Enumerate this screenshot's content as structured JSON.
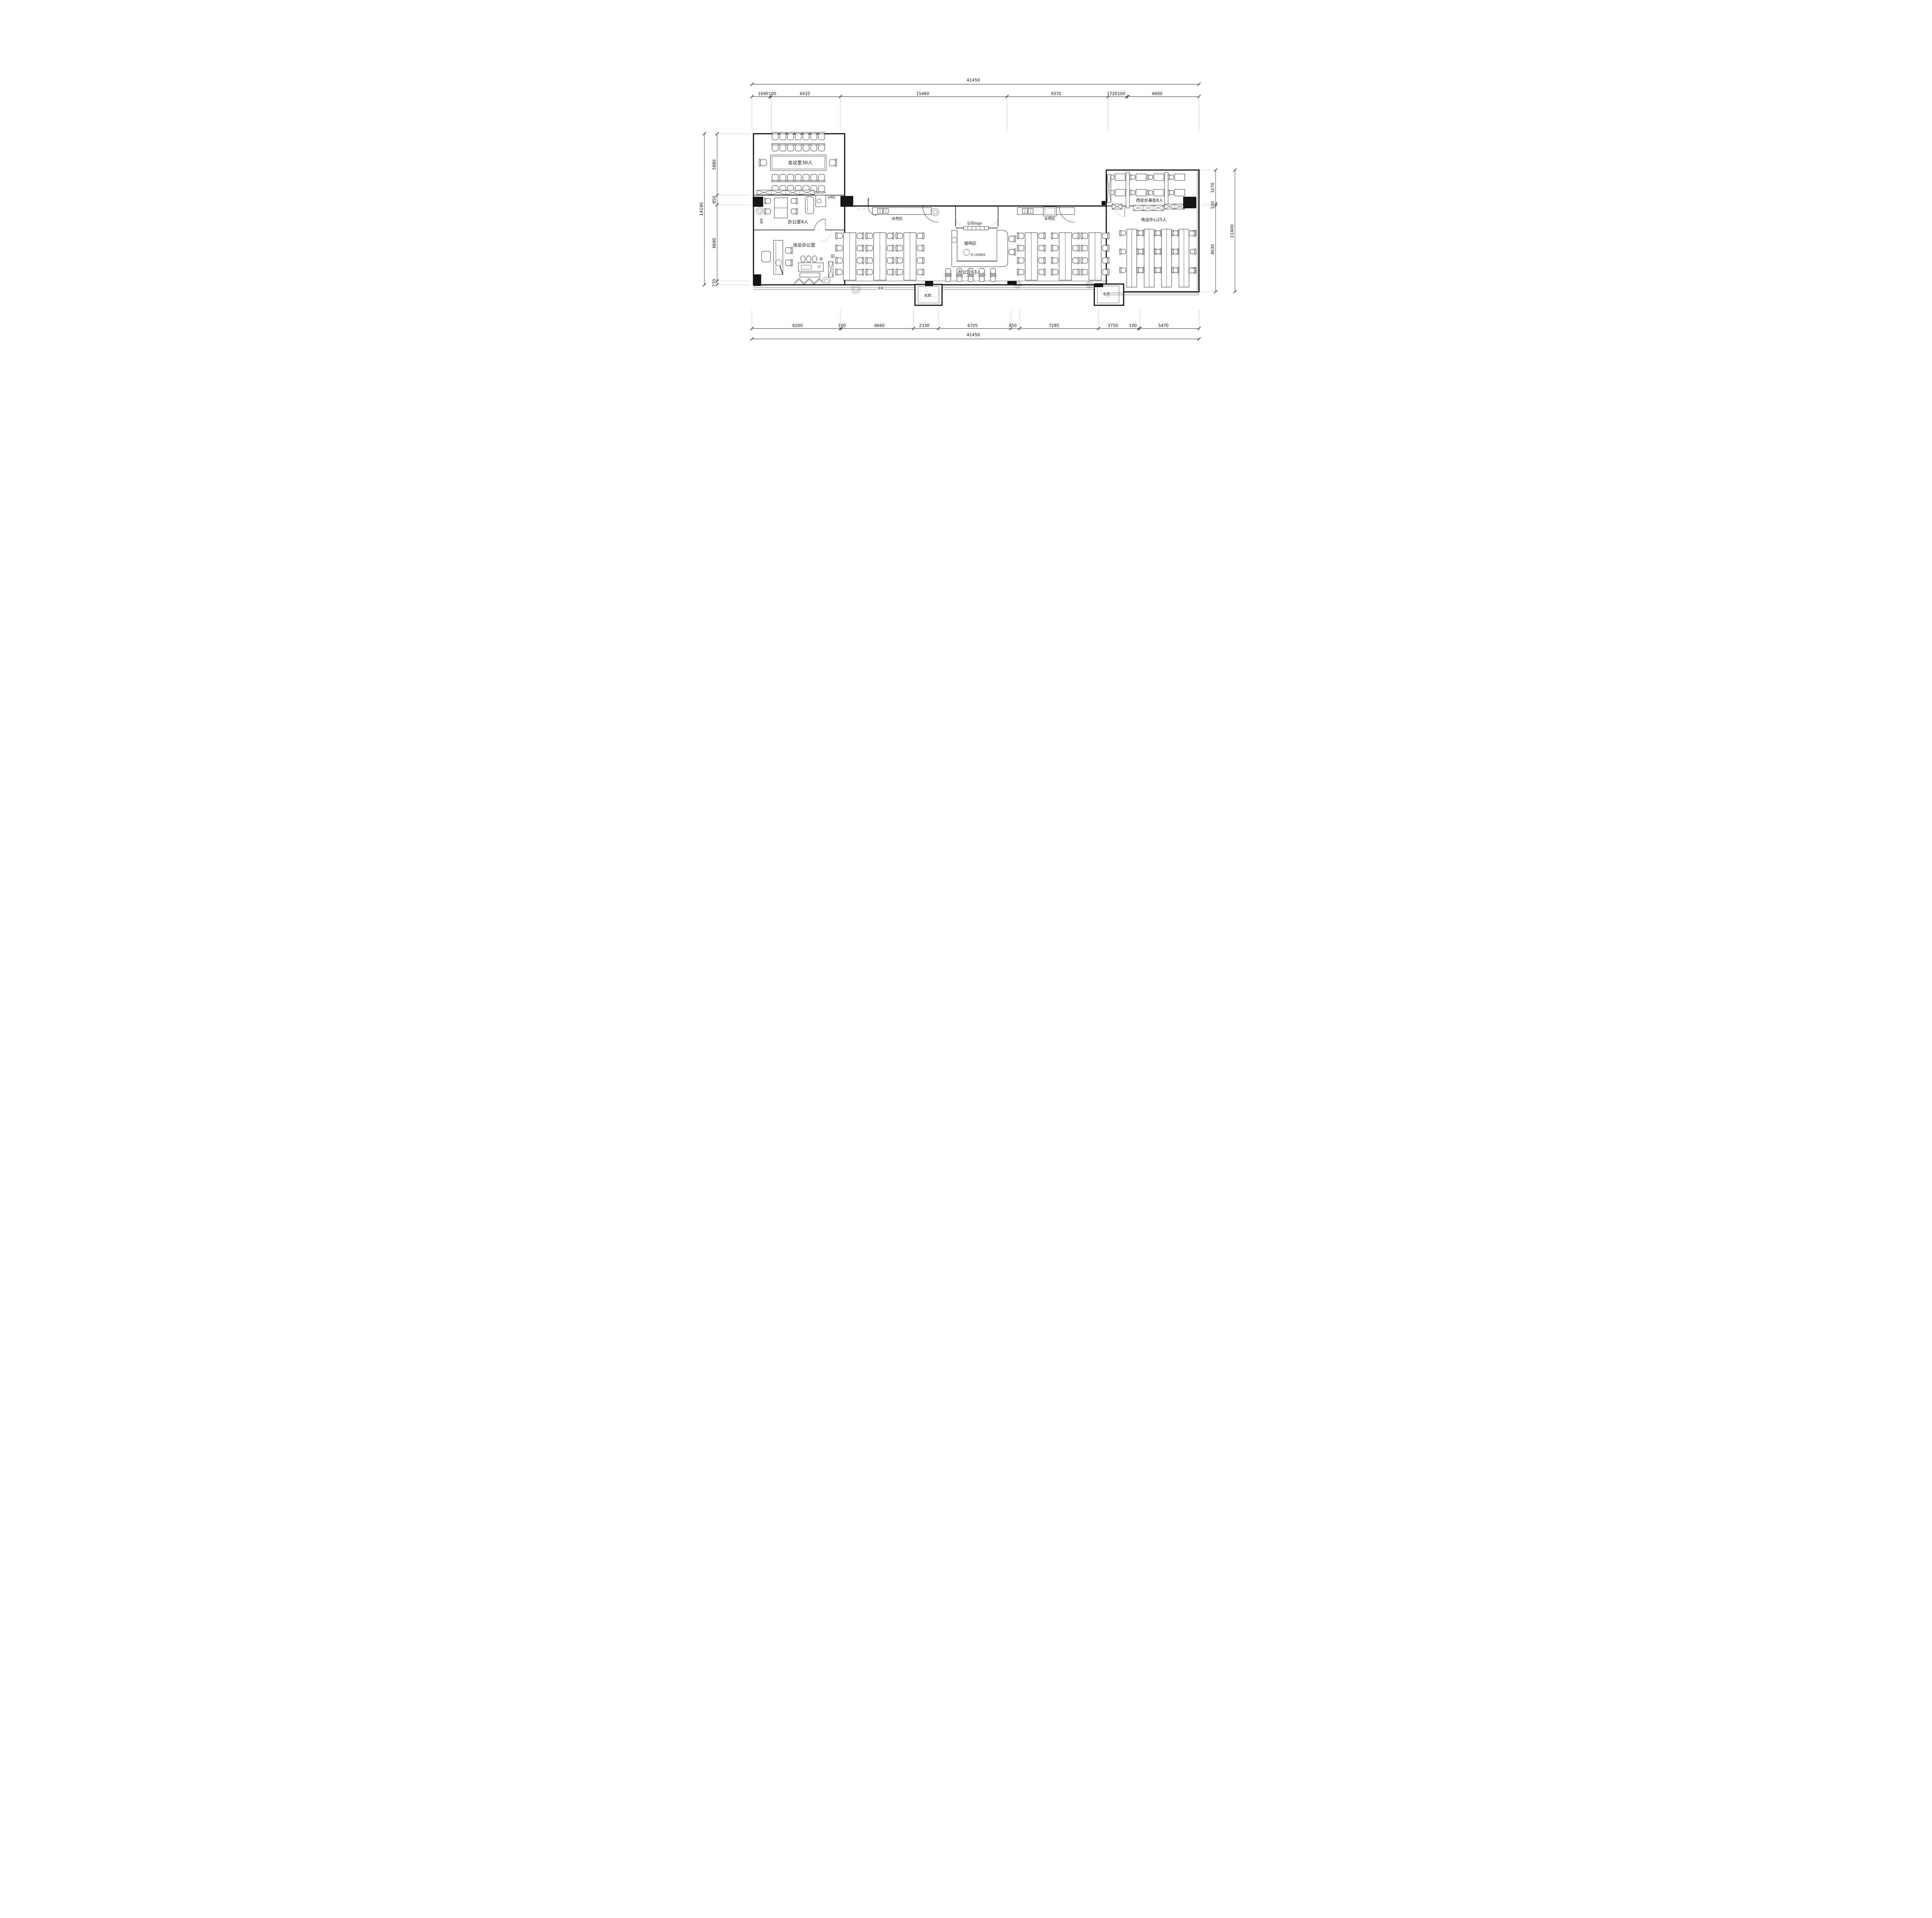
{
  "dimensions": {
    "top": {
      "total": "41450",
      "segments": [
        "1690",
        "100",
        "6410",
        "15460",
        "9370",
        "1720",
        "100",
        "6600"
      ]
    },
    "bottom": {
      "total": "41450",
      "segments": [
        "8200",
        "100",
        "6660",
        "2330",
        "6705",
        "850",
        "7285",
        "3750",
        "100",
        "5470"
      ]
    },
    "left": {
      "total": "14190",
      "segments": [
        "5880",
        "850",
        "6690",
        "770"
      ]
    },
    "right": {
      "total": "11400",
      "segments": [
        "3270",
        "100",
        "8030"
      ]
    }
  },
  "rooms": {
    "conference": "会议室30人",
    "office4": "办公室4人",
    "manager": "张总办公室",
    "waterbar_office": "水吧区",
    "waterbar_left": "水吧区",
    "waterbar_right": "水吧区",
    "logo_wall": "公司logo",
    "reception": "接待区",
    "staff_display": "员工风采展示",
    "open_office": "办公区63人",
    "xian_office": "西安办事处8人",
    "call_center": "电话中心25人",
    "machine_room_left": "机房",
    "machine_room_right": "机房",
    "landscape_left": "造景",
    "landscape_bottom": "造景"
  }
}
